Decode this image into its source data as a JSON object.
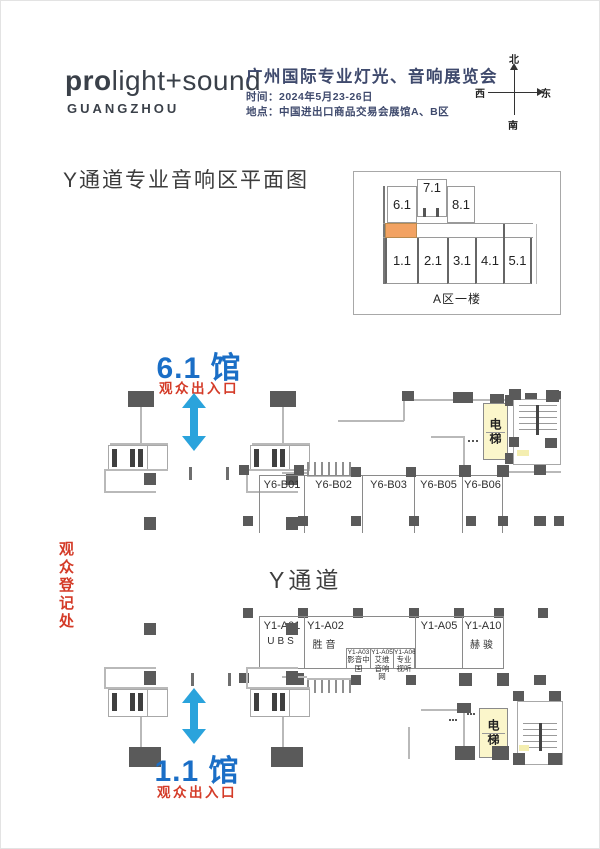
{
  "header": {
    "logo": {
      "bold": "pro",
      "rest": "light+sound",
      "city": "GUANGZHOU"
    },
    "expo_title": "广州国际专业灯光、音响展览会",
    "date_line": "时间：2024年5月23-26日",
    "venue_line": "地点：中国进出口商品交易会展馆A、B区",
    "compass": {
      "north": "北",
      "south": "南",
      "east": "东",
      "west": "西"
    }
  },
  "page": {
    "section_title": "Y通道专业音响区平面图"
  },
  "overview": {
    "caption": "A区一楼",
    "halls_top": [
      "6.1",
      "7.1",
      "8.1"
    ],
    "halls_bottom": [
      "1.1",
      "2.1",
      "3.1",
      "4.1",
      "5.1"
    ]
  },
  "upper": {
    "hall": "6.1 馆",
    "gate": "观众出入口",
    "elevator": "电梯",
    "booths": [
      "Y6-B01",
      "Y6-B02",
      "Y6-B03",
      "Y6-B05",
      "Y6-B06"
    ]
  },
  "middle": {
    "channel": "Y通道",
    "registration": "观众登记处"
  },
  "lower": {
    "hall": "1.1 馆",
    "gate": "观众出入口",
    "elevator": "电梯",
    "booths": [
      {
        "id": "Y1-A01",
        "name": "UBS"
      },
      {
        "id": "Y1-A02",
        "name": "胜音"
      },
      {
        "id": "Y1-A03",
        "name": "影音中国"
      },
      {
        "id": "Y1-A05",
        "name": "艾维音响网"
      },
      {
        "id": "Y1-A06",
        "name": "专业视听"
      },
      {
        "id": "Y1-A05",
        "name": ""
      },
      {
        "id": "Y1-A10",
        "name": "赫骏"
      }
    ]
  },
  "colors": {
    "title_navy": "#3f4a6d",
    "logo_ink": "#3a4049",
    "accent_blue": "#1a6ec6",
    "arrow_blue": "#2aa3dc",
    "accent_red": "#d43b28",
    "highlight_orange": "#f2a262",
    "elevator_yellow": "#fbf6cb",
    "wall_gray": "#b9b9b9",
    "column_gray": "#5a5a5a",
    "text_dark": "#3e3e3e"
  }
}
